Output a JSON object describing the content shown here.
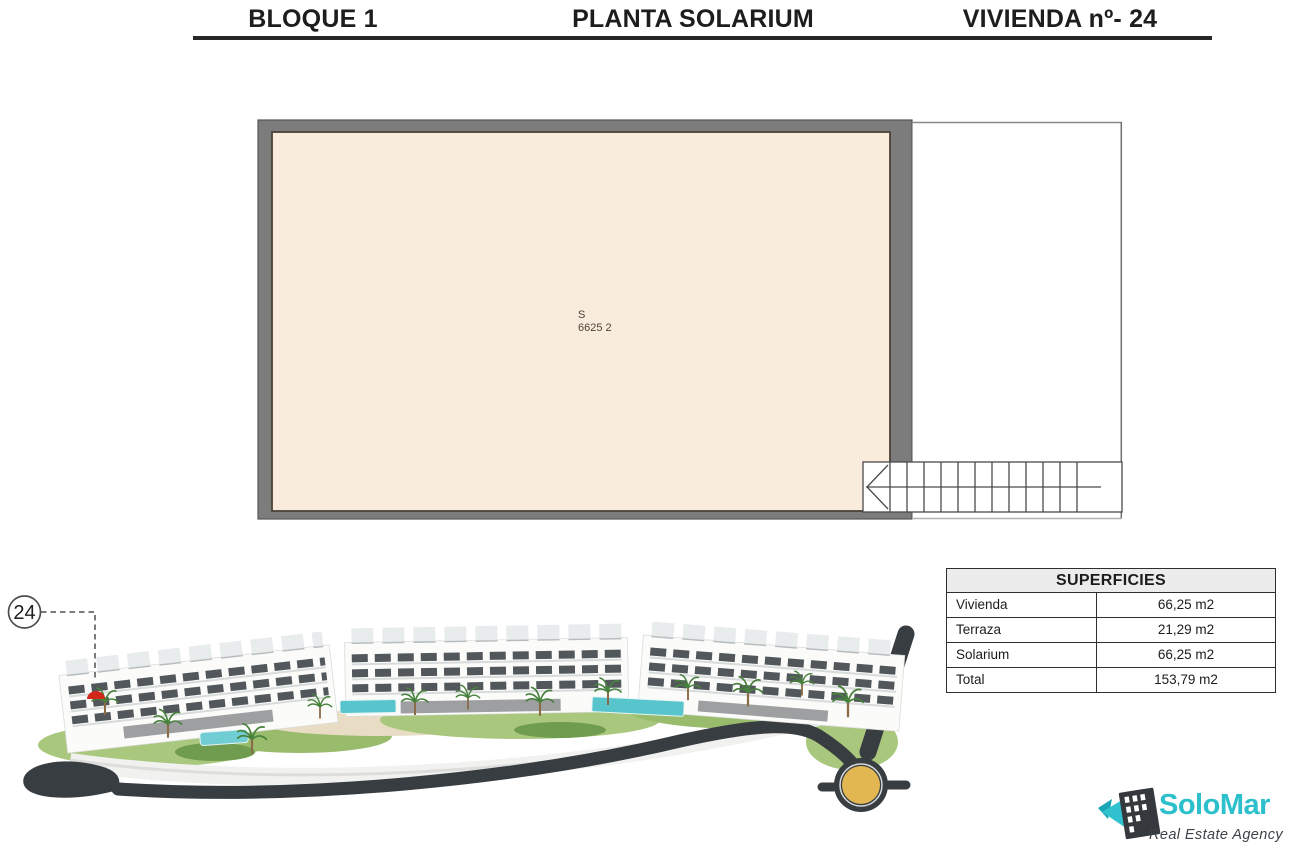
{
  "header": {
    "block_label": "BLOQUE 1",
    "floor_label": "PLANTA SOLARIUM",
    "unit_label": "VIVIENDA nº- 24"
  },
  "floorplan": {
    "room_code": "S",
    "room_area": "6625 2"
  },
  "site_render": {
    "unit_number": "24"
  },
  "surfaces_table": {
    "title": "SUPERFICIES",
    "rows": [
      {
        "label": "Vivienda",
        "value": "66,25 m2"
      },
      {
        "label": "Terraza",
        "value": "21,29 m2"
      },
      {
        "label": "Solarium",
        "value": "66,25 m2"
      },
      {
        "label": "Total",
        "value": "153,79 m2"
      }
    ]
  },
  "logo": {
    "brand": "SoloMar",
    "tagline": "Real Estate Agency"
  },
  "colors": {
    "accent_teal": "#2cc0cd",
    "plan_floor_beige": "#f9ecdc",
    "wall_gray": "#7c7c7c",
    "road_dark": "#383d41",
    "roundabout_gold": "#e2b751",
    "highlight_red": "#d3271c"
  }
}
